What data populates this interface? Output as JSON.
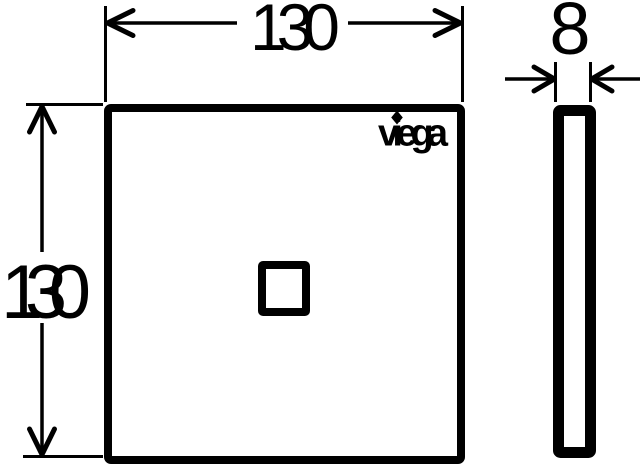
{
  "canvas": {
    "background": "#ffffff",
    "ink": "#000000"
  },
  "drawing": {
    "kind": "technical-dimension-drawing",
    "front_view": {
      "width_value": "130",
      "height_value": "130",
      "brand": "viega"
    },
    "side_view": {
      "thickness_value": "8"
    }
  }
}
